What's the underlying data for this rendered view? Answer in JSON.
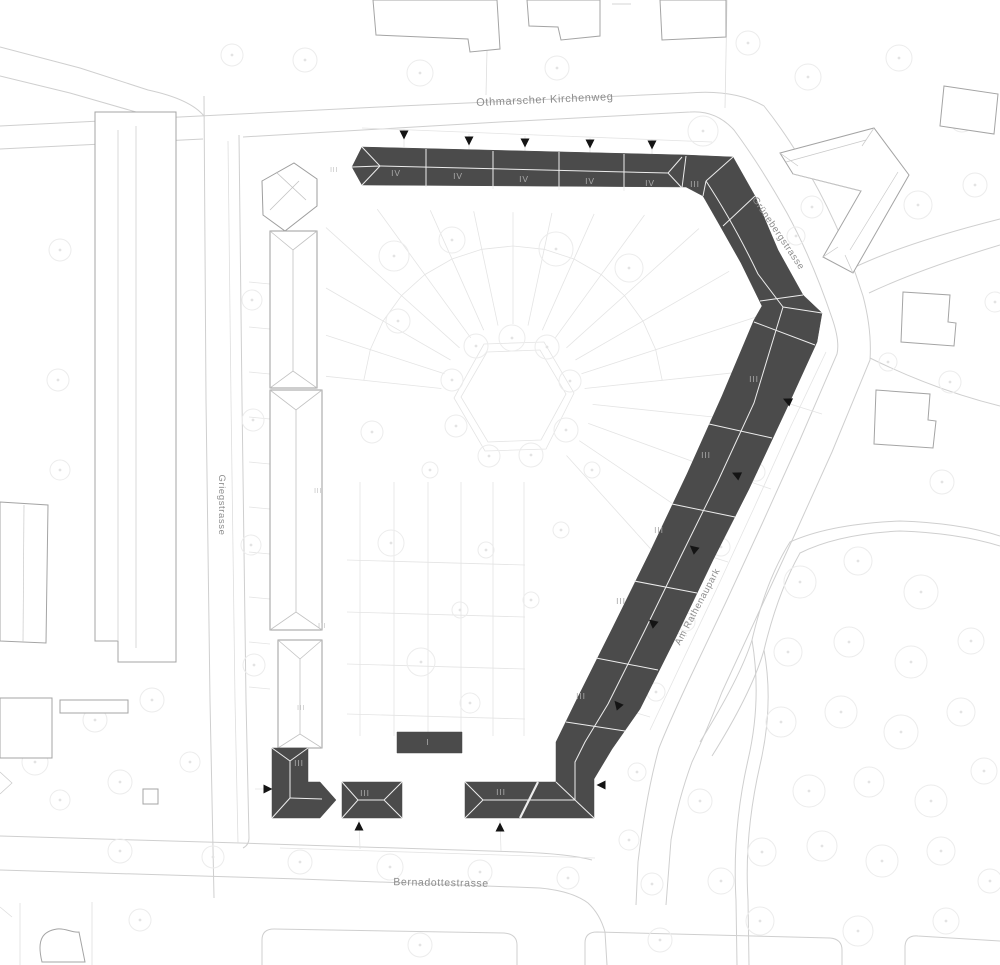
{
  "map": {
    "streets": [
      {
        "name": "Othmarscher Kirchenweg",
        "x": 545,
        "y": 103,
        "rotate": -2.5,
        "size": 11
      },
      {
        "name": "Grünebergstrasse",
        "x": 776,
        "y": 235,
        "rotate": 56,
        "size": 9.5
      },
      {
        "name": "Am Rathenaupark",
        "x": 700,
        "y": 608,
        "rotate": -62,
        "size": 9.5
      },
      {
        "name": "Griegstrasse",
        "x": 219,
        "y": 505,
        "rotate": 90,
        "size": 9.5
      },
      {
        "name": "Bernadottestrasse",
        "x": 441,
        "y": 886,
        "rotate": 1,
        "size": 10.5
      }
    ],
    "floor_labels_dark": [
      {
        "text": "IV",
        "x": 396,
        "y": 176
      },
      {
        "text": "IV",
        "x": 458,
        "y": 179
      },
      {
        "text": "IV",
        "x": 524,
        "y": 182
      },
      {
        "text": "IV",
        "x": 590,
        "y": 184
      },
      {
        "text": "IV",
        "x": 650,
        "y": 186
      },
      {
        "text": "III",
        "x": 695,
        "y": 187
      },
      {
        "text": "III",
        "x": 754,
        "y": 382
      },
      {
        "text": "III",
        "x": 706,
        "y": 458
      },
      {
        "text": "III",
        "x": 659,
        "y": 533
      },
      {
        "text": "III",
        "x": 621,
        "y": 604
      },
      {
        "text": "III",
        "x": 581,
        "y": 699
      },
      {
        "text": "III",
        "x": 501,
        "y": 795
      },
      {
        "text": "I",
        "x": 428,
        "y": 745
      },
      {
        "text": "III",
        "x": 365,
        "y": 796
      },
      {
        "text": "III",
        "x": 299,
        "y": 766
      }
    ],
    "floor_labels_light": [
      {
        "text": "III",
        "x": 334,
        "y": 172
      },
      {
        "text": "III",
        "x": 318,
        "y": 493
      },
      {
        "text": "III",
        "x": 322,
        "y": 628
      },
      {
        "text": "III",
        "x": 301,
        "y": 710
      }
    ],
    "entrances": [
      {
        "x": 404,
        "y": 134,
        "rot": 180
      },
      {
        "x": 469,
        "y": 140,
        "rot": 180
      },
      {
        "x": 525,
        "y": 142,
        "rot": 180
      },
      {
        "x": 590,
        "y": 143,
        "rot": 180
      },
      {
        "x": 652,
        "y": 144,
        "rot": 180
      },
      {
        "x": 788,
        "y": 401,
        "rot": -65
      },
      {
        "x": 737,
        "y": 475,
        "rot": -65
      },
      {
        "x": 694,
        "y": 549,
        "rot": -50
      },
      {
        "x": 653,
        "y": 623,
        "rot": -50
      },
      {
        "x": 618,
        "y": 705,
        "rot": -40
      },
      {
        "x": 602,
        "y": 785,
        "rot": -90
      },
      {
        "x": 359,
        "y": 827,
        "rot": 0
      },
      {
        "x": 500,
        "y": 828,
        "rot": 0
      },
      {
        "x": 267,
        "y": 789,
        "rot": 90
      }
    ],
    "colors": {
      "building_dark": "#4b4b4b",
      "ridge_light": "#ededed",
      "entrance_marker": "#141414",
      "street_label": "#8d8d8d",
      "floor_label_on_dark": "#a9a9a9",
      "floor_label_on_light": "#c6c6c6",
      "curb_line": "#cfcfcf",
      "context_outline": "#a4a4a4",
      "parcel_line": "#e4e4e4",
      "tree_outline": "#ececec"
    }
  }
}
